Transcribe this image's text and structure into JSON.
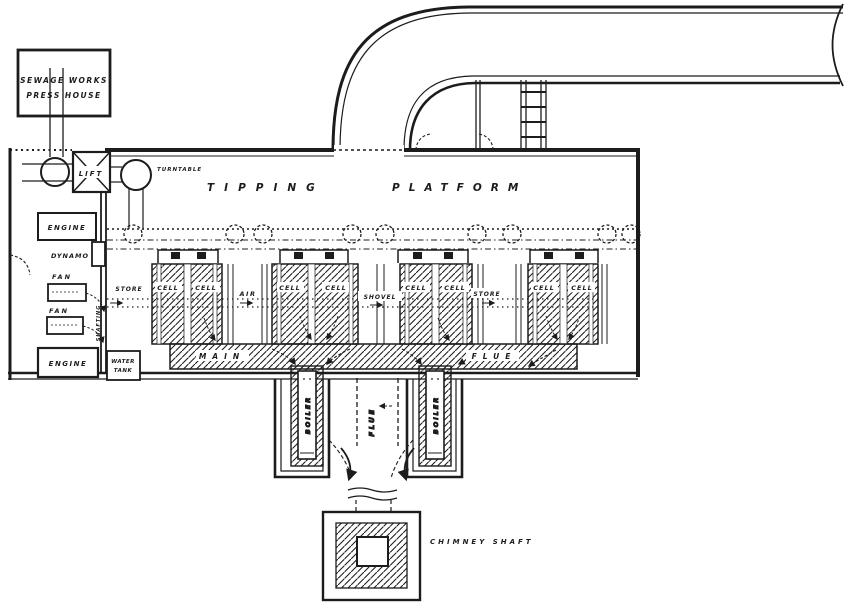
{
  "colors": {
    "ink": "#1c1c1c",
    "paper": "#ffffff"
  },
  "labels": {
    "press_house_line1": "SEWAGE WORKS",
    "press_house_line2": "PRESS HOUSE",
    "lift": "LIFT",
    "turntable": "TURNTABLE",
    "tipping": "TIPPING",
    "platform": "PLATFORM",
    "engine_top": "ENGINE",
    "dynamo": "DYNAMO",
    "fan_top": "FAN",
    "fan_bottom": "FAN",
    "engine_bottom": "ENGINE",
    "water_tank_line1": "WATER",
    "water_tank_line2": "TANK",
    "shafting": "SHAFTING",
    "store_left": "STORE",
    "air": "AIR",
    "shovel": "SHOVEL",
    "store_right": "STORE",
    "main_flue_word1": "MAIN",
    "main_flue_word2": "FLUE",
    "boiler_left": "BOILER",
    "boiler_right": "BOILER",
    "flue": "FLUE",
    "chimney_shaft": "CHIMNEY SHAFT",
    "cells": [
      "CELL",
      "CELL",
      "CELL",
      "CELL",
      "CELL",
      "CELL",
      "CELL",
      "CELL"
    ]
  }
}
